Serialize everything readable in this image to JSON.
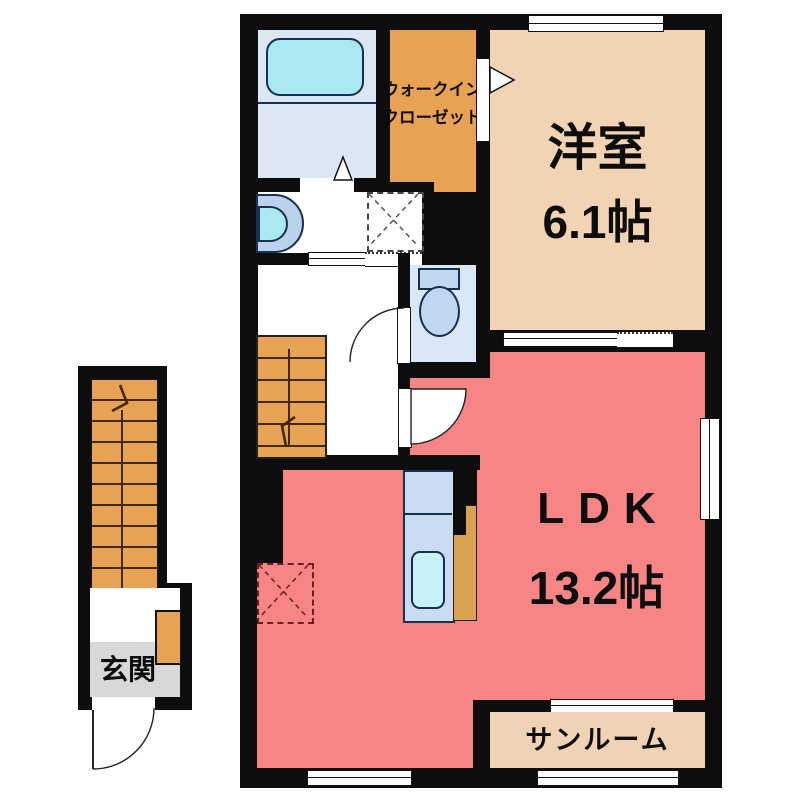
{
  "plan": {
    "type": "apartment-floor-plan",
    "rooms": {
      "western_room": {
        "name": "洋室",
        "area": "6.1帖"
      },
      "ldk": {
        "name": "LDK",
        "area": "13.2帖"
      },
      "walk_in_closet": {
        "line1": "ウォークイン",
        "line2": "クローゼット"
      },
      "sunroom": {
        "name": "サンルーム"
      },
      "entrance": {
        "name": "玄関"
      }
    },
    "fixtures": [
      "bathtub-icon",
      "washbasin-icon",
      "washing-machine-space-icon",
      "toilet-icon",
      "kitchen-sink-icon",
      "refrigerator-space-icon",
      "exterior-staircase",
      "interior-staircase",
      "entrance-door-arc",
      "toilet-door-arc",
      "ldk-door-arc",
      "bath-folding-door-icon",
      "closet-door-arrow-icon"
    ],
    "palette": {
      "wall": "#0d0d0d",
      "ldk": "#f78585",
      "western_room": "#f2d3b3",
      "sunroom": "#f0d3b4",
      "closet_orange": "#e8a254",
      "stairs_orange": "#e8a254",
      "bath_blue": "#dce7f5",
      "toilet_blue": "#d9e7f7",
      "fixture_blue": "#c2d7f0",
      "water_cyan": "#abe9f2",
      "kitchen_counter": "#c9dcf2",
      "genkan_gray": "#d8d8d8"
    }
  }
}
